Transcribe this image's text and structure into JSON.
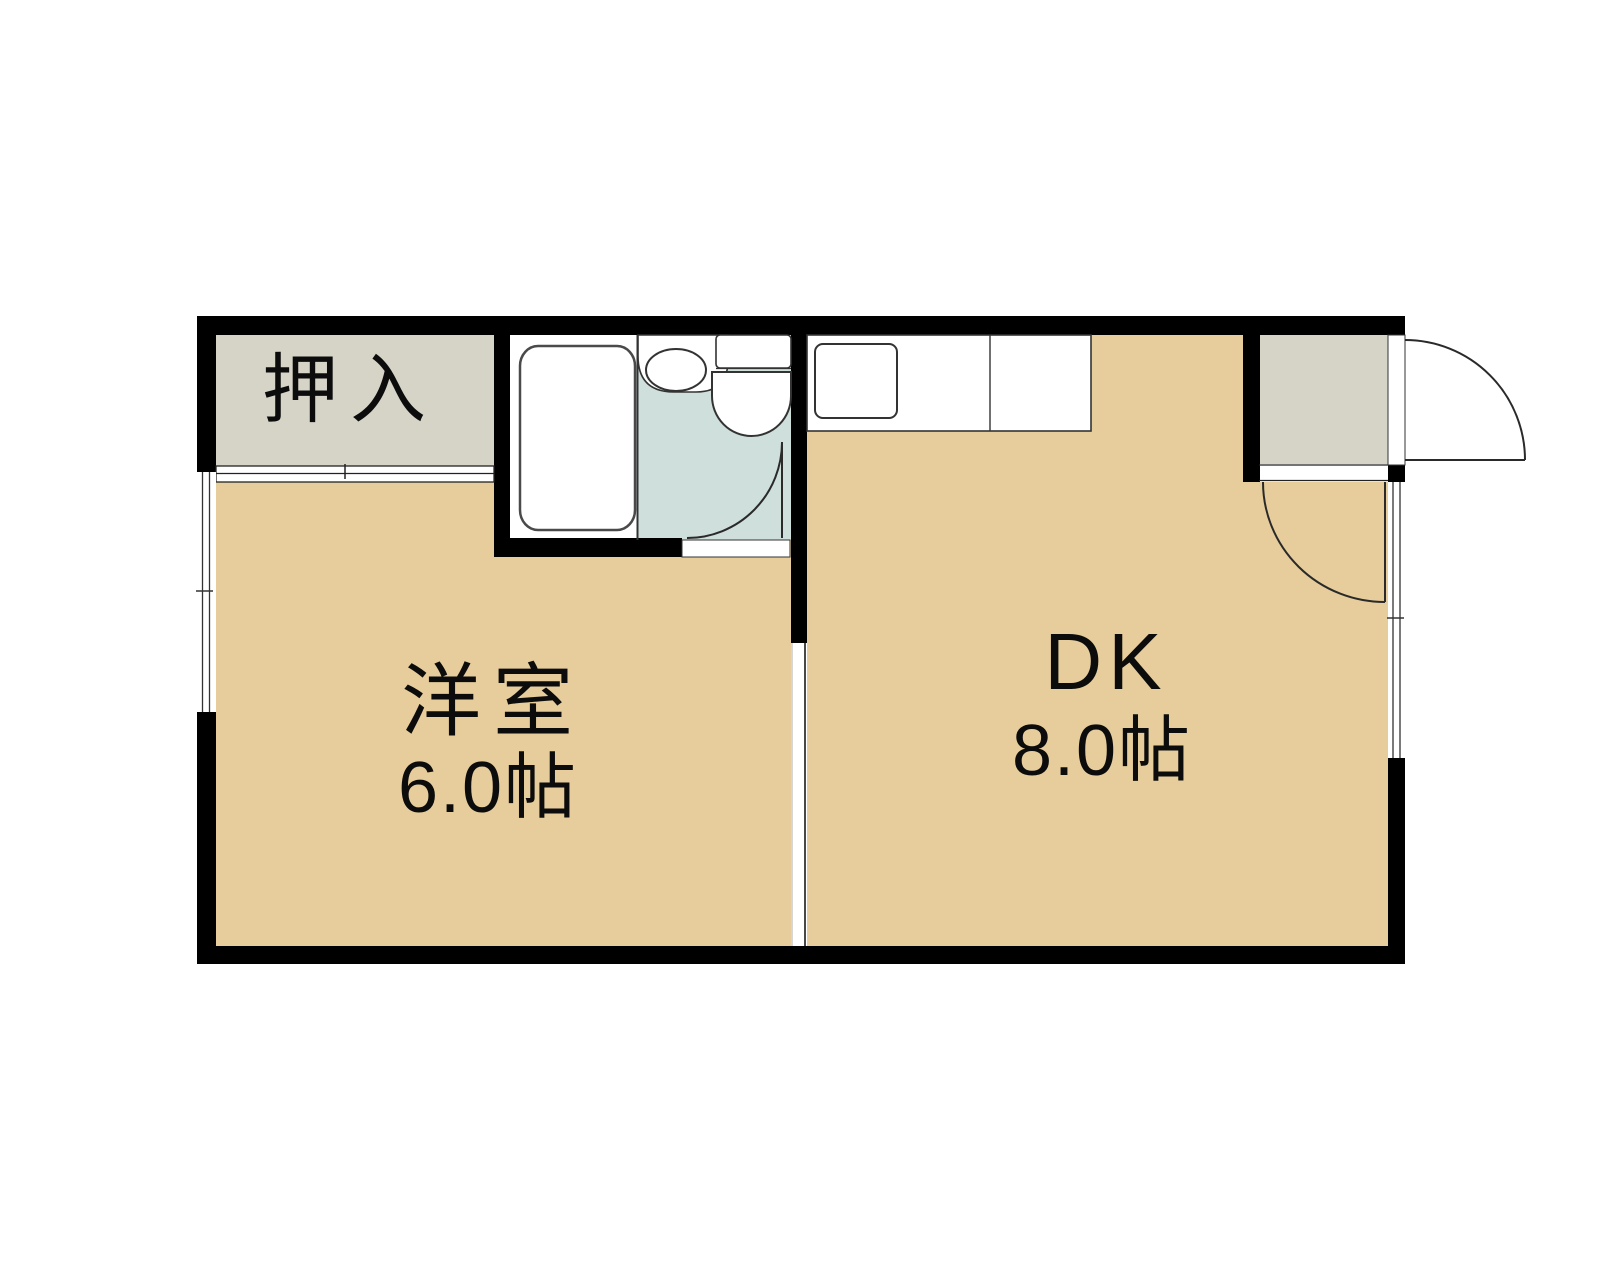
{
  "plan": {
    "type": "apartment-floor-plan",
    "layout_name": "1DK"
  },
  "colors": {
    "wall": "#000000",
    "floor": "#e6cd9b",
    "closet": "#d6d3c7",
    "entrance": "#d6d3c7",
    "bathroom": "#cfe0dc",
    "fixture": "#ffffff",
    "outline": "#333333"
  },
  "rooms": {
    "closet": {
      "label": "押入"
    },
    "western_room": {
      "label": "洋室",
      "size": "6.0帖"
    },
    "dining_kitchen": {
      "label": "DK",
      "size": "8.0帖"
    }
  }
}
